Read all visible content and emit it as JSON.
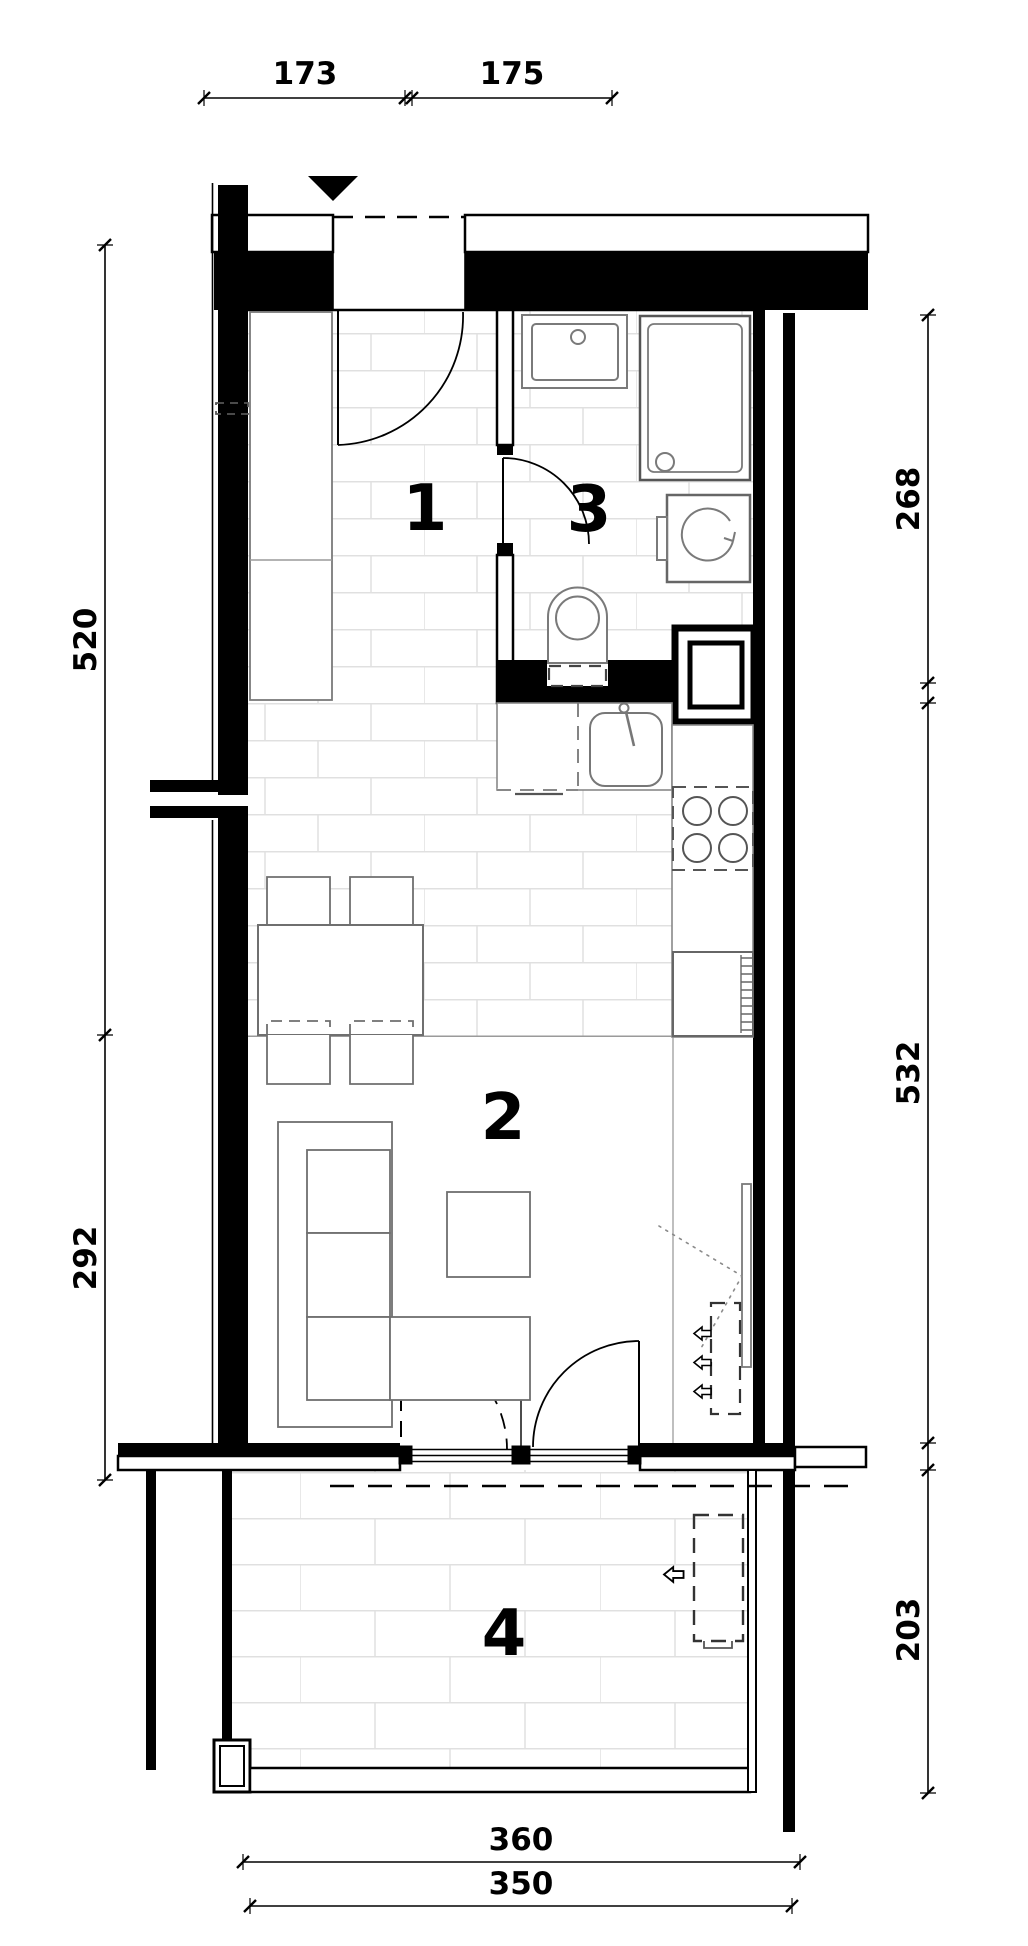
{
  "drawing": {
    "type": "apartment-floor-plan",
    "rooms": [
      {
        "number": "1"
      },
      {
        "number": "2"
      },
      {
        "number": "3"
      },
      {
        "number": "4"
      }
    ],
    "dimensions": {
      "top": [
        {
          "value": "173"
        },
        {
          "value": "175"
        }
      ],
      "left": [
        {
          "value": "520"
        },
        {
          "value": "292"
        }
      ],
      "right": [
        {
          "value": "268"
        },
        {
          "value": "532"
        },
        {
          "value": "203"
        }
      ],
      "bottom": [
        {
          "value": "360"
        },
        {
          "value": "350"
        }
      ]
    },
    "symbols": {
      "entrance_marker": "down-triangle",
      "airflow_arrow": "left-arrow"
    },
    "colors": {
      "wall": "#000000",
      "furniture": "#6f6f6f",
      "dashed_item": "#3a3a3a",
      "tile_line": "#e0e0e0",
      "dotted_line": "#8a8a8a"
    }
  }
}
